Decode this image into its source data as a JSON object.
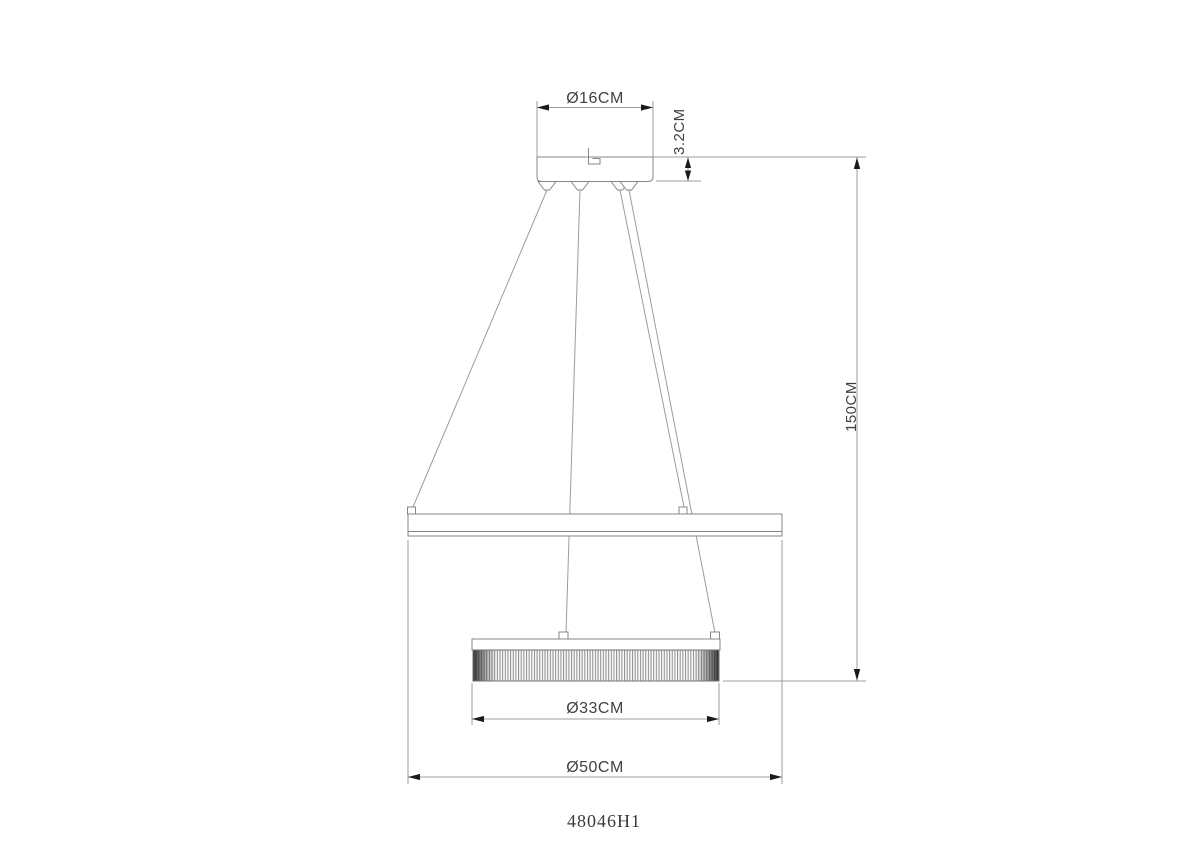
{
  "drawing": {
    "kind": "pendant-lamp-dimension-drawing",
    "model": "48046H1",
    "labels": {
      "canopy_diameter": "Ø16CM",
      "canopy_height": "3.2CM",
      "drop_height": "150CM",
      "inner_diameter": "Ø33CM",
      "outer_diameter": "Ø50CM"
    },
    "colors": {
      "background": "#ffffff",
      "line": "#9c9c9c",
      "outline": "#878787",
      "arrow": "#1a1a1a",
      "dimension_text": "#414141",
      "model_text": "#3a3a3a"
    }
  }
}
